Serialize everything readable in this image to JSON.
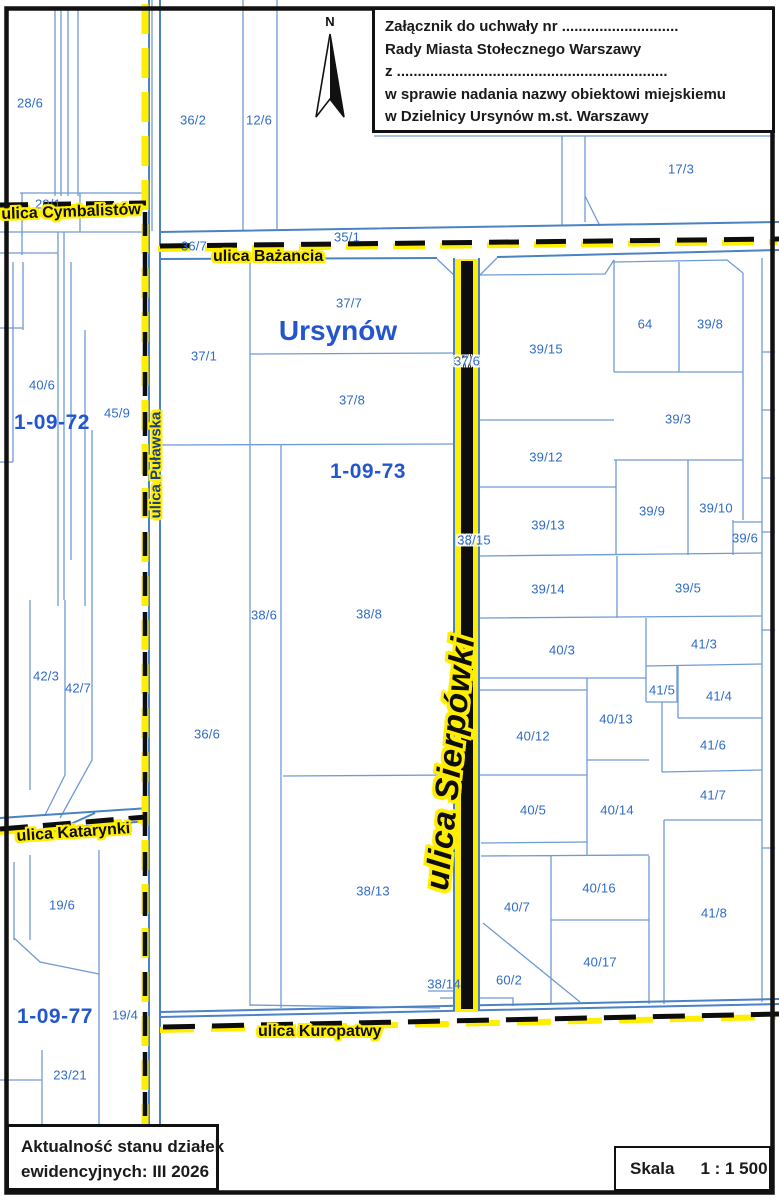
{
  "annotation_box": {
    "lines": [
      "Załącznik do uchwały nr ............................",
      "Rady Miasta Stołecznego Warszawy",
      "z .................................................................",
      "w sprawie nadania nazwy obiektowi miejskiemu",
      "w Dzielnicy Ursynów m.st. Warszawy"
    ]
  },
  "info_box": {
    "line1": "Aktualność stanu działek",
    "line2": "ewidencyjnych: III 2026"
  },
  "scale_box": {
    "label": "Skala",
    "value": "1 : 1 500"
  },
  "map": {
    "north_label": "N",
    "region_label": "Ursynów",
    "colors": {
      "parcel_line": "#6f9bd2",
      "road_line": "#4a82c4",
      "parcel_text": "#2e6bc8",
      "district_text": "#2356cd",
      "street_highlight": "#ffee00",
      "street_ink": "#0d0d0d"
    },
    "streets": [
      {
        "name": "ulica Cymbalistów"
      },
      {
        "name": "ulica Bażancia"
      },
      {
        "name": "ulica Puławska"
      },
      {
        "name": "ulica Katarynki"
      },
      {
        "name": "ulica Kuropatwy"
      },
      {
        "name": "ulica Sierpówki"
      }
    ],
    "districts": [
      {
        "label": "1-09-72",
        "x": 52,
        "y": 423
      },
      {
        "label": "1-09-73",
        "x": 368,
        "y": 472
      },
      {
        "label": "1-09-77",
        "x": 55,
        "y": 1017
      }
    ],
    "parcels": [
      {
        "label": "28/6",
        "x": 30,
        "y": 103
      },
      {
        "label": "29/1",
        "x": 48,
        "y": 204
      },
      {
        "label": "36/2",
        "x": 193,
        "y": 120
      },
      {
        "label": "12/6",
        "x": 259,
        "y": 120
      },
      {
        "label": "17/3",
        "x": 681,
        "y": 169
      },
      {
        "label": "36/7",
        "x": 194,
        "y": 246
      },
      {
        "label": "35/1",
        "x": 347,
        "y": 237
      },
      {
        "label": "37/7",
        "x": 349,
        "y": 303
      },
      {
        "label": "37/1",
        "x": 204,
        "y": 356
      },
      {
        "label": "40/6",
        "x": 42,
        "y": 385
      },
      {
        "label": "45/9",
        "x": 117,
        "y": 413
      },
      {
        "label": "37/6",
        "x": 467,
        "y": 361,
        "halo": true
      },
      {
        "label": "39/15",
        "x": 546,
        "y": 349
      },
      {
        "label": "64",
        "x": 645,
        "y": 324
      },
      {
        "label": "39/8",
        "x": 710,
        "y": 324
      },
      {
        "label": "39/3",
        "x": 678,
        "y": 419
      },
      {
        "label": "37/8",
        "x": 352,
        "y": 400
      },
      {
        "label": "39/12",
        "x": 546,
        "y": 457
      },
      {
        "label": "39/13",
        "x": 548,
        "y": 525
      },
      {
        "label": "39/9",
        "x": 652,
        "y": 511
      },
      {
        "label": "39/10",
        "x": 716,
        "y": 508
      },
      {
        "label": "39/6",
        "x": 745,
        "y": 538
      },
      {
        "label": "38/15",
        "x": 474,
        "y": 540,
        "halo": true
      },
      {
        "label": "39/14",
        "x": 548,
        "y": 589
      },
      {
        "label": "39/5",
        "x": 688,
        "y": 588
      },
      {
        "label": "38/6",
        "x": 264,
        "y": 615
      },
      {
        "label": "38/8",
        "x": 369,
        "y": 614
      },
      {
        "label": "40/3",
        "x": 562,
        "y": 650
      },
      {
        "label": "41/3",
        "x": 704,
        "y": 644
      },
      {
        "label": "42/3",
        "x": 46,
        "y": 676
      },
      {
        "label": "42/7",
        "x": 78,
        "y": 688
      },
      {
        "label": "41/5",
        "x": 662,
        "y": 690
      },
      {
        "label": "41/4",
        "x": 719,
        "y": 696
      },
      {
        "label": "40/13",
        "x": 616,
        "y": 719
      },
      {
        "label": "36/6",
        "x": 207,
        "y": 734
      },
      {
        "label": "40/12",
        "x": 533,
        "y": 736
      },
      {
        "label": "41/6",
        "x": 713,
        "y": 745
      },
      {
        "label": "41/7",
        "x": 713,
        "y": 795
      },
      {
        "label": "40/5",
        "x": 533,
        "y": 810
      },
      {
        "label": "40/14",
        "x": 617,
        "y": 810
      },
      {
        "label": "40/16",
        "x": 599,
        "y": 888
      },
      {
        "label": "38/13",
        "x": 373,
        "y": 891
      },
      {
        "label": "40/7",
        "x": 517,
        "y": 907
      },
      {
        "label": "19/6",
        "x": 62,
        "y": 905
      },
      {
        "label": "41/8",
        "x": 714,
        "y": 913
      },
      {
        "label": "40/17",
        "x": 600,
        "y": 962
      },
      {
        "label": "60/2",
        "x": 509,
        "y": 980
      },
      {
        "label": "38/14",
        "x": 444,
        "y": 984
      },
      {
        "label": "19/4",
        "x": 125,
        "y": 1015
      },
      {
        "label": "23/21",
        "x": 70,
        "y": 1075
      }
    ]
  }
}
